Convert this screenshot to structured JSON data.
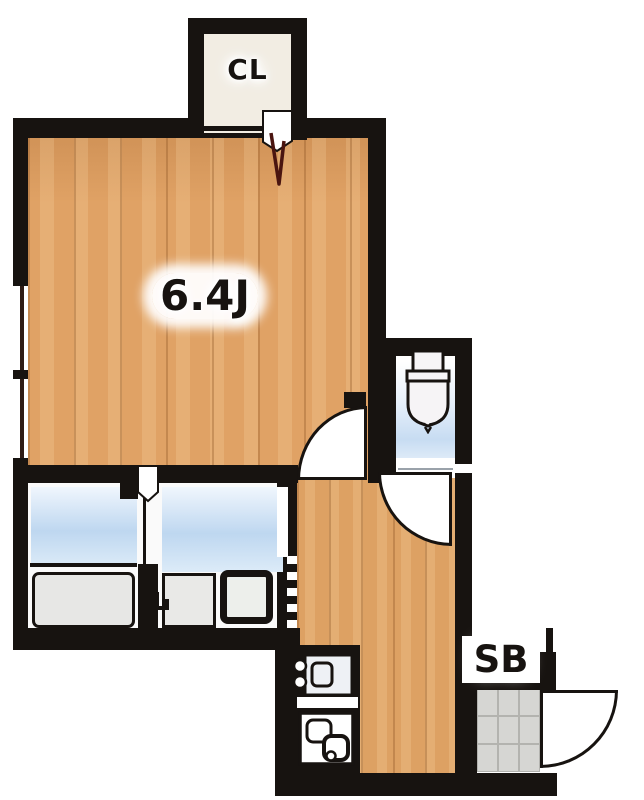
{
  "plan": {
    "labels": {
      "main_room": "6.4J",
      "closet": "CL",
      "shoe_box": "SB"
    },
    "rooms": {
      "main_room_size_tatami": "6.4J",
      "closet_abbr": "CL",
      "shoe_box_abbr": "SB"
    },
    "colors": {
      "wall": "#171310",
      "wood_floor": "#e0a265",
      "wood_plank_line": "#b97f42",
      "water_blue": "#bed7f0",
      "tile_gray": "#d6d6d3",
      "fixture_gray": "#e9e9e7",
      "door_mark_red": "#4a1510",
      "background": "#ffffff"
    }
  }
}
